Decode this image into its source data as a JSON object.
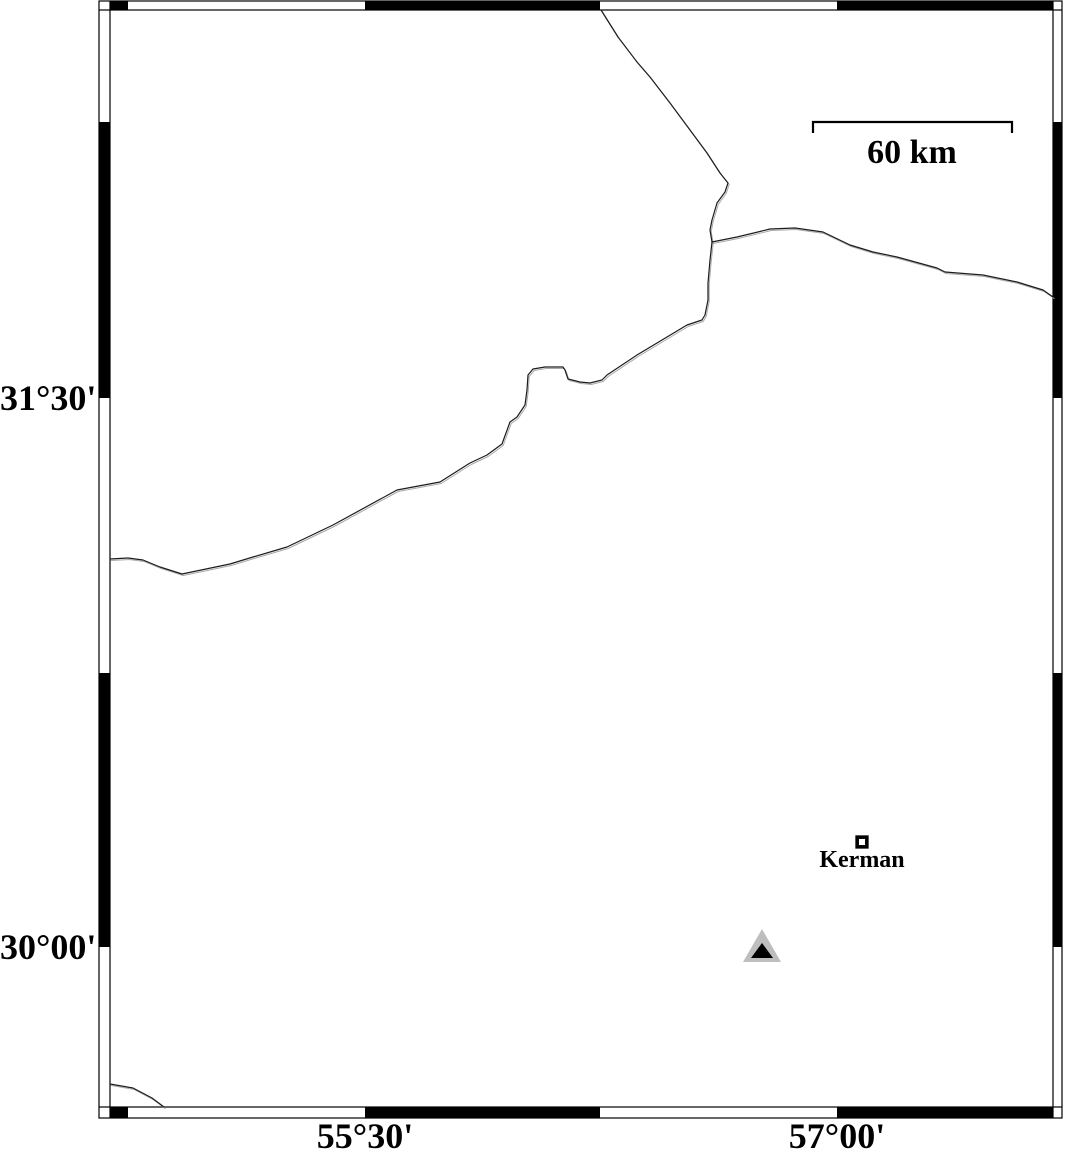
{
  "figure": {
    "width": 1066,
    "height": 1157,
    "background": "#ffffff"
  },
  "colors": {
    "line": "#1c1c1c",
    "line_shadow": "#a8a8a8",
    "frame_black": "#000000",
    "frame_line": "#000000",
    "white": "#ffffff",
    "triangle_gray": "#bebebe",
    "triangle_black": "#000000"
  },
  "frame": {
    "outer": {
      "x1": 99,
      "y1": 1,
      "x2": 1062,
      "y2": 1118
    },
    "inner": {
      "x1": 110,
      "y1": 10,
      "x2": 1053,
      "y2": 1107
    },
    "top_black_segments": [
      [
        110,
        128
      ],
      [
        365,
        600
      ],
      [
        837,
        1053
      ]
    ],
    "bottom_black_segments": [
      [
        110,
        128
      ],
      [
        365,
        600
      ],
      [
        837,
        1053
      ]
    ],
    "left_black_segments": [
      [
        122,
        398
      ],
      [
        673,
        947
      ]
    ],
    "right_black_segments": [
      [
        122,
        398
      ],
      [
        673,
        947
      ]
    ]
  },
  "axes": {
    "left": [
      {
        "label": "31°30'",
        "y": 398
      },
      {
        "label": "30°00'",
        "y": 947
      }
    ],
    "bottom": [
      {
        "label": "55°30'",
        "x": 365
      },
      {
        "label": "57°00'",
        "x": 837
      }
    ]
  },
  "scale_bar": {
    "label": "60 km",
    "x1": 813,
    "x2": 1012,
    "y": 122,
    "tick_drop": 11,
    "stroke_width": 2.2
  },
  "markers": {
    "city": {
      "label": "Kerman",
      "x": 862,
      "y": 842,
      "size": 13.3,
      "border": 3.6
    },
    "station": {
      "outer": {
        "points": [
          [
            762,
            929
          ],
          [
            743,
            962
          ],
          [
            781,
            962
          ]
        ],
        "fill": "#bebebe"
      },
      "inner": {
        "points": [
          [
            762,
            943
          ],
          [
            751,
            958
          ],
          [
            773,
            958
          ]
        ],
        "fill": "#000000"
      }
    }
  },
  "borders": [
    {
      "name": "border-line-north",
      "points": [
        [
          601,
          10
        ],
        [
          618,
          37
        ],
        [
          637,
          62
        ],
        [
          650,
          77
        ],
        [
          670,
          103
        ],
        [
          690,
          130
        ],
        [
          707,
          153
        ],
        [
          720,
          173
        ],
        [
          728,
          183
        ],
        [
          725,
          192
        ],
        [
          717,
          203
        ],
        [
          712,
          220
        ],
        [
          710,
          230
        ],
        [
          712,
          242
        ]
      ]
    },
    {
      "name": "border-line-east",
      "points": [
        [
          712,
          242
        ],
        [
          737,
          237
        ],
        [
          770,
          229
        ],
        [
          795,
          228
        ],
        [
          823,
          232
        ],
        [
          850,
          245
        ],
        [
          873,
          252
        ],
        [
          897,
          257
        ],
        [
          937,
          268
        ],
        [
          945,
          272
        ],
        [
          983,
          275
        ],
        [
          1017,
          282
        ],
        [
          1043,
          290
        ],
        [
          1053,
          297
        ]
      ]
    },
    {
      "name": "border-line-southwest",
      "points": [
        [
          712,
          242
        ],
        [
          710,
          260
        ],
        [
          708,
          283
        ],
        [
          708,
          300
        ],
        [
          705,
          315
        ],
        [
          702,
          320
        ],
        [
          687,
          325
        ],
        [
          667,
          337
        ],
        [
          637,
          355
        ],
        [
          607,
          375
        ],
        [
          602,
          380
        ],
        [
          590,
          383
        ],
        [
          580,
          382
        ],
        [
          568,
          379
        ],
        [
          565,
          370
        ],
        [
          563,
          367
        ],
        [
          545,
          367
        ],
        [
          533,
          369
        ],
        [
          528,
          375
        ],
        [
          527,
          390
        ],
        [
          525,
          405
        ],
        [
          517,
          417
        ],
        [
          510,
          422
        ],
        [
          506,
          433
        ],
        [
          502,
          444
        ],
        [
          487,
          455
        ],
        [
          470,
          463
        ],
        [
          440,
          482
        ],
        [
          397,
          490
        ],
        [
          333,
          525
        ],
        [
          287,
          547
        ],
        [
          253,
          557
        ],
        [
          230,
          564
        ],
        [
          182,
          574
        ],
        [
          160,
          567
        ],
        [
          143,
          560
        ],
        [
          128,
          558
        ],
        [
          110,
          559
        ]
      ]
    },
    {
      "name": "border-line-bottom-left",
      "points": [
        [
          110,
          1084
        ],
        [
          133,
          1088
        ],
        [
          152,
          1098
        ],
        [
          164,
          1107
        ]
      ]
    }
  ]
}
